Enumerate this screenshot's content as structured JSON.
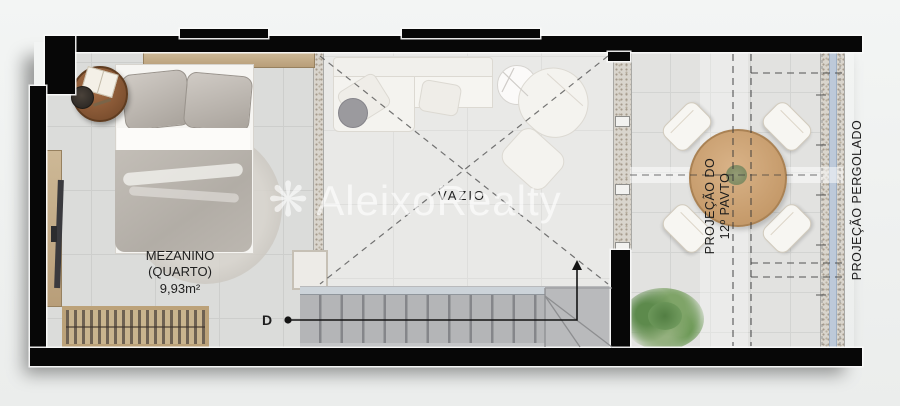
{
  "plan": {
    "room_label": {
      "name": "MEZANINO",
      "qualifier": "(QUARTO)",
      "area": "9,93m²"
    },
    "void_label": "VAZIO",
    "stairs": {
      "direction_label": "D"
    },
    "projections": {
      "floor_above_line1": "PROJEÇÃO DO",
      "floor_above_line2": "12º PAVTO",
      "pergola": "PROJEÇÃO PERGOLADO"
    }
  },
  "watermark": {
    "brand": "AleixoRealty",
    "icon_glyph": "❋"
  },
  "palette": {
    "wall": "#070707",
    "floor_bedroom": "#dbdcda",
    "floor_void": "#e9e9e7",
    "floor_terrace": "#e2e2e0",
    "stairs": "#b9babc",
    "landing_edge": "#ccd3d9",
    "wood_light": "#c9b58f",
    "table_wood": "#c59a6a",
    "plant_green": "#6f9a5d",
    "flowers_red": "#b8484f",
    "pergola_line": "#bdc9d9"
  }
}
